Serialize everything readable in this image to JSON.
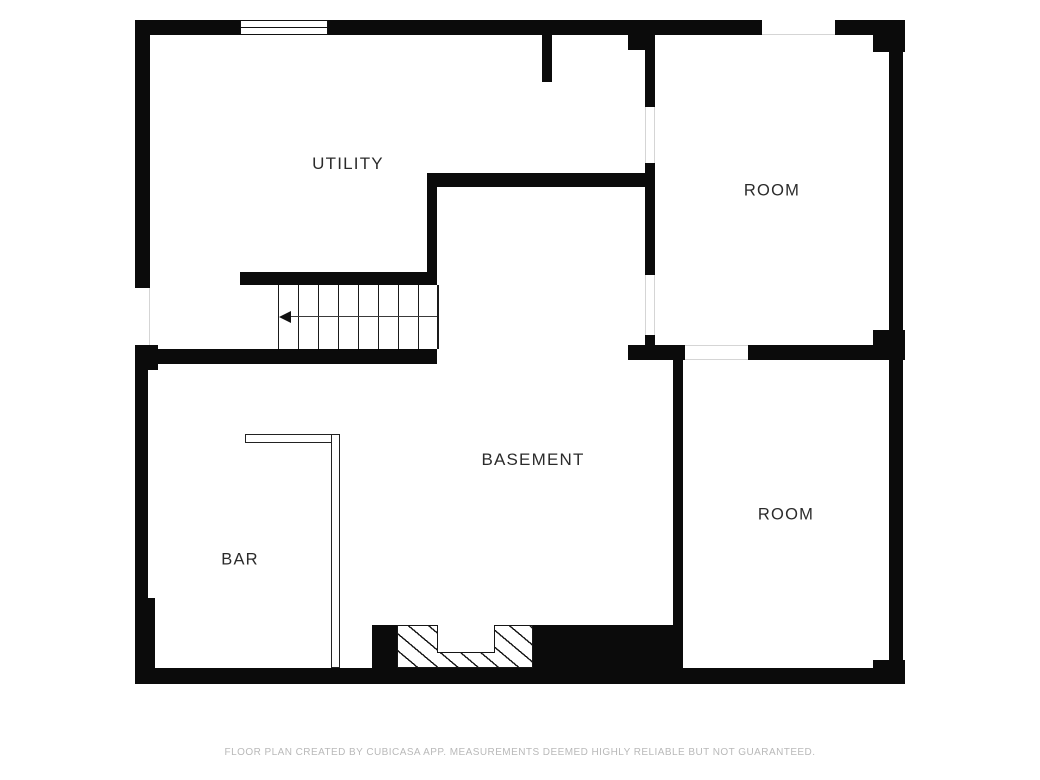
{
  "title": "Basement floor plan",
  "colors": {
    "wall": "#0b0b0b",
    "background": "#ffffff",
    "label_text": "#2b2b2b",
    "footer_text": "#b9b9b9",
    "stair_line": "#1a1a1a",
    "opening_edge": "#d5d5d5",
    "counter_edge": "#222222",
    "hatch_line": "#161616"
  },
  "rooms": [
    {
      "id": "utility",
      "label": "UTILITY",
      "cx": 348,
      "cy": 164,
      "size": 17
    },
    {
      "id": "room-upper-right",
      "label": "ROOM",
      "cx": 772,
      "cy": 191,
      "size": 16.5
    },
    {
      "id": "basement",
      "label": "BASEMENT",
      "cx": 533,
      "cy": 460,
      "size": 17
    },
    {
      "id": "bar",
      "label": "BAR",
      "cx": 240,
      "cy": 560,
      "size": 16.5
    },
    {
      "id": "room-lower-right",
      "label": "ROOM",
      "cx": 786,
      "cy": 515,
      "size": 16.5
    }
  ],
  "footer": {
    "disclaimer": "FLOOR PLAN CREATED BY CUBICASA APP. MEASUREMENTS DEEMED HIGHLY RELIABLE BUT NOT GUARANTEED."
  },
  "plan": {
    "walls": [
      {
        "name": "top-wall-left",
        "x": 135,
        "y": 20,
        "w": 105,
        "h": 15
      },
      {
        "name": "top-wall-middle",
        "x": 328,
        "y": 20,
        "w": 434,
        "h": 15
      },
      {
        "name": "top-wall-right",
        "x": 835,
        "y": 20,
        "w": 70,
        "h": 15
      },
      {
        "name": "top-right-corner-block",
        "x": 873,
        "y": 32,
        "w": 32,
        "h": 20
      },
      {
        "name": "right-wall-upper",
        "x": 889,
        "y": 52,
        "w": 14,
        "h": 278
      },
      {
        "name": "right-wall-middle-block",
        "x": 873,
        "y": 330,
        "w": 32,
        "h": 30
      },
      {
        "name": "right-wall-lower",
        "x": 889,
        "y": 360,
        "w": 14,
        "h": 300
      },
      {
        "name": "right-wall-bottom-block",
        "x": 873,
        "y": 660,
        "w": 32,
        "h": 24
      },
      {
        "name": "bottom-wall",
        "x": 135,
        "y": 668,
        "w": 770,
        "h": 16
      },
      {
        "name": "left-wall-upper",
        "x": 135,
        "y": 20,
        "w": 15,
        "h": 268
      },
      {
        "name": "left-wall-junction-block",
        "x": 135,
        "y": 345,
        "w": 23,
        "h": 25
      },
      {
        "name": "left-wall-middle",
        "x": 135,
        "y": 370,
        "w": 13,
        "h": 228
      },
      {
        "name": "left-wall-lower",
        "x": 135,
        "y": 598,
        "w": 20,
        "h": 86
      },
      {
        "name": "chimney-flue-stub",
        "x": 542,
        "y": 35,
        "w": 10,
        "h": 47
      },
      {
        "name": "utility-room-wall-top-block",
        "x": 628,
        "y": 32,
        "w": 27,
        "h": 18
      },
      {
        "name": "utility-room-wall-upper",
        "x": 645,
        "y": 48,
        "w": 10,
        "h": 59
      },
      {
        "name": "utility-room-wall-middle",
        "x": 645,
        "y": 163,
        "w": 10,
        "h": 112
      },
      {
        "name": "utility-room-wall-lower-stub",
        "x": 645,
        "y": 335,
        "w": 10,
        "h": 25
      },
      {
        "name": "utility-hall-wall",
        "x": 427,
        "y": 173,
        "w": 218,
        "h": 14
      },
      {
        "name": "hall-wall-vertical",
        "x": 427,
        "y": 173,
        "w": 10,
        "h": 112
      },
      {
        "name": "stairs-top-wall",
        "x": 240,
        "y": 272,
        "w": 197,
        "h": 13
      },
      {
        "name": "stairs-bottom-wall",
        "x": 148,
        "y": 349,
        "w": 289,
        "h": 15
      },
      {
        "name": "mid-right-wall-left",
        "x": 628,
        "y": 345,
        "w": 57,
        "h": 15
      },
      {
        "name": "mid-right-wall-right",
        "x": 748,
        "y": 345,
        "w": 157,
        "h": 15
      },
      {
        "name": "basement-room-divider",
        "x": 673,
        "y": 350,
        "w": 10,
        "h": 334
      },
      {
        "name": "fireplace-left-block",
        "x": 372,
        "y": 625,
        "w": 25,
        "h": 47
      },
      {
        "name": "fireplace-chimney-block",
        "x": 533,
        "y": 625,
        "w": 140,
        "h": 59
      }
    ],
    "openings": [
      {
        "name": "opening-top-wall",
        "x": 762,
        "y": 20,
        "w": 73,
        "h": 15,
        "edges": "b"
      },
      {
        "name": "opening-left-wall",
        "x": 135,
        "y": 288,
        "w": 15,
        "h": 57,
        "edges": "r"
      },
      {
        "name": "door-utility-to-room",
        "x": 645,
        "y": 107,
        "w": 10,
        "h": 56,
        "edges": "lr"
      },
      {
        "name": "opening-hall-to-room",
        "x": 645,
        "y": 275,
        "w": 10,
        "h": 60,
        "edges": "lr"
      },
      {
        "name": "door-basement-to-room",
        "x": 685,
        "y": 345,
        "w": 63,
        "h": 15,
        "edges": "tb"
      }
    ],
    "windows": [
      {
        "name": "window-top-wall",
        "x": 240,
        "y": 20,
        "w": 88,
        "h": 15
      }
    ],
    "stairs": {
      "x": 278,
      "y": 285,
      "w": 159,
      "h": 64,
      "tread_count": 8,
      "mid_y": 31,
      "arrow_dir": "left"
    },
    "bar_counter": [
      {
        "name": "bar-counter-front",
        "x": 245,
        "y": 434,
        "w": 87,
        "h": 9
      },
      {
        "name": "bar-counter-side",
        "x": 331,
        "y": 434,
        "w": 9,
        "h": 234
      }
    ],
    "fireplace": {
      "hatch_box": {
        "x": 397,
        "y": 625,
        "w": 136,
        "h": 43
      },
      "firebox_notch": {
        "x": 437,
        "y": 625,
        "w": 58,
        "h": 28
      }
    }
  }
}
